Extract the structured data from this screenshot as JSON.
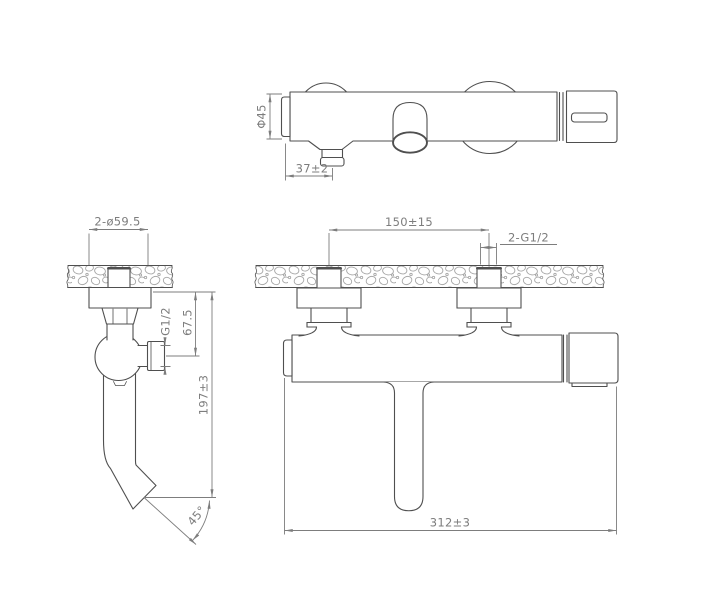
{
  "drawing_type": "faucet-installation-technical-drawing",
  "colors": {
    "line": "#4f4f4f",
    "dimension": "#7d7d7d",
    "hatch": "#a6a6a6",
    "background": "#ffffff"
  },
  "views": {
    "top": {
      "dim_body_diameter": "Φ45",
      "dim_spout_offset": "37±2"
    },
    "side": {
      "dim_escutcheon_diameter": "2-ø59.5",
      "dim_outlet_thread": "G1/2",
      "dim_outlet_height": "67.5",
      "dim_spout_drop": "197±3",
      "dim_spout_angle": "45°"
    },
    "front": {
      "dim_inlet_centers": "150±15",
      "dim_inlet_thread": "2-G1/2",
      "dim_overall_width": "312±3"
    }
  }
}
